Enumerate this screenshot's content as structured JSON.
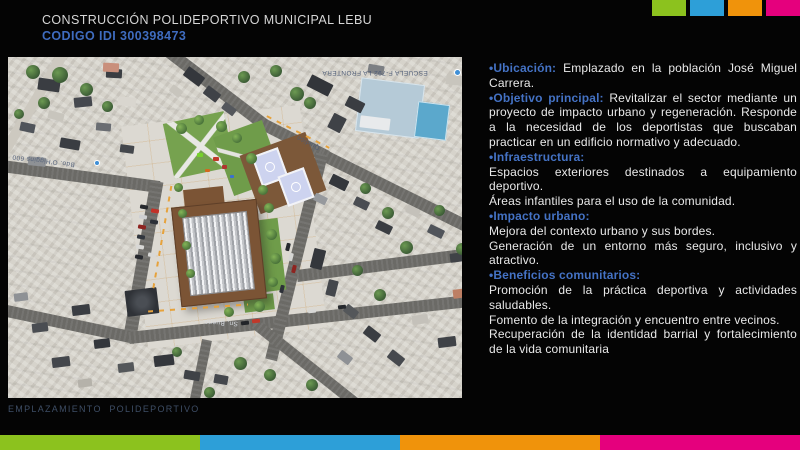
{
  "slide": {
    "title": "CONSTRUCCIÓN POLIDEPORTIVO MUNICIPAL LEBU",
    "code": "CODIGO IDI 300398473",
    "caption": "EMPLAZAMIENTO  POLIDEPORTIVO"
  },
  "palette": {
    "accent_green": "#8CC21E",
    "accent_blue": "#2D9FD8",
    "accent_orange": "#F0930B",
    "accent_pink": "#E5007D",
    "heading_blue": "#4472C4",
    "code_blue": "#3F6CBF",
    "caption_blue": "#3E4E66",
    "body_text": "#E9E9E9"
  },
  "map": {
    "labels": {
      "school": "ESCUELA F-792 LA FRONTERA",
      "street_left": "Bdo. O'Higgins 600",
      "street_bottom": "Sn. Bueno",
      "street_right": "Quidico"
    }
  },
  "content": {
    "bullet": "•",
    "sections": [
      {
        "label": "Ubicación:",
        "text": "Emplazado en la población José Miguel Carrera."
      },
      {
        "label": "Objetivo principal:",
        "text": "Revitalizar el sector mediante un proyecto de impacto urbano y regeneración. Responde a la necesidad de los deportistas que buscaban practicar en un edificio normativo y adecuado."
      },
      {
        "label": "Infraestructura:",
        "lines": [
          "Espacios exteriores destinados a equipamiento deportivo.",
          "Áreas infantiles para el uso de la comunidad."
        ]
      },
      {
        "label": "Impacto urbano:",
        "lines": [
          "Mejora del contexto urbano y sus bordes.",
          "Generación de un entorno más seguro, inclusivo y atractivo."
        ]
      },
      {
        "label": "Beneficios comunitarios:",
        "lines": [
          "Promoción de la práctica deportiva y actividades saludables.",
          "Fomento de la integración y encuentro entre vecinos.",
          "Recuperación de la identidad barrial y fortalecimiento de la vida comunitaria"
        ]
      }
    ]
  }
}
